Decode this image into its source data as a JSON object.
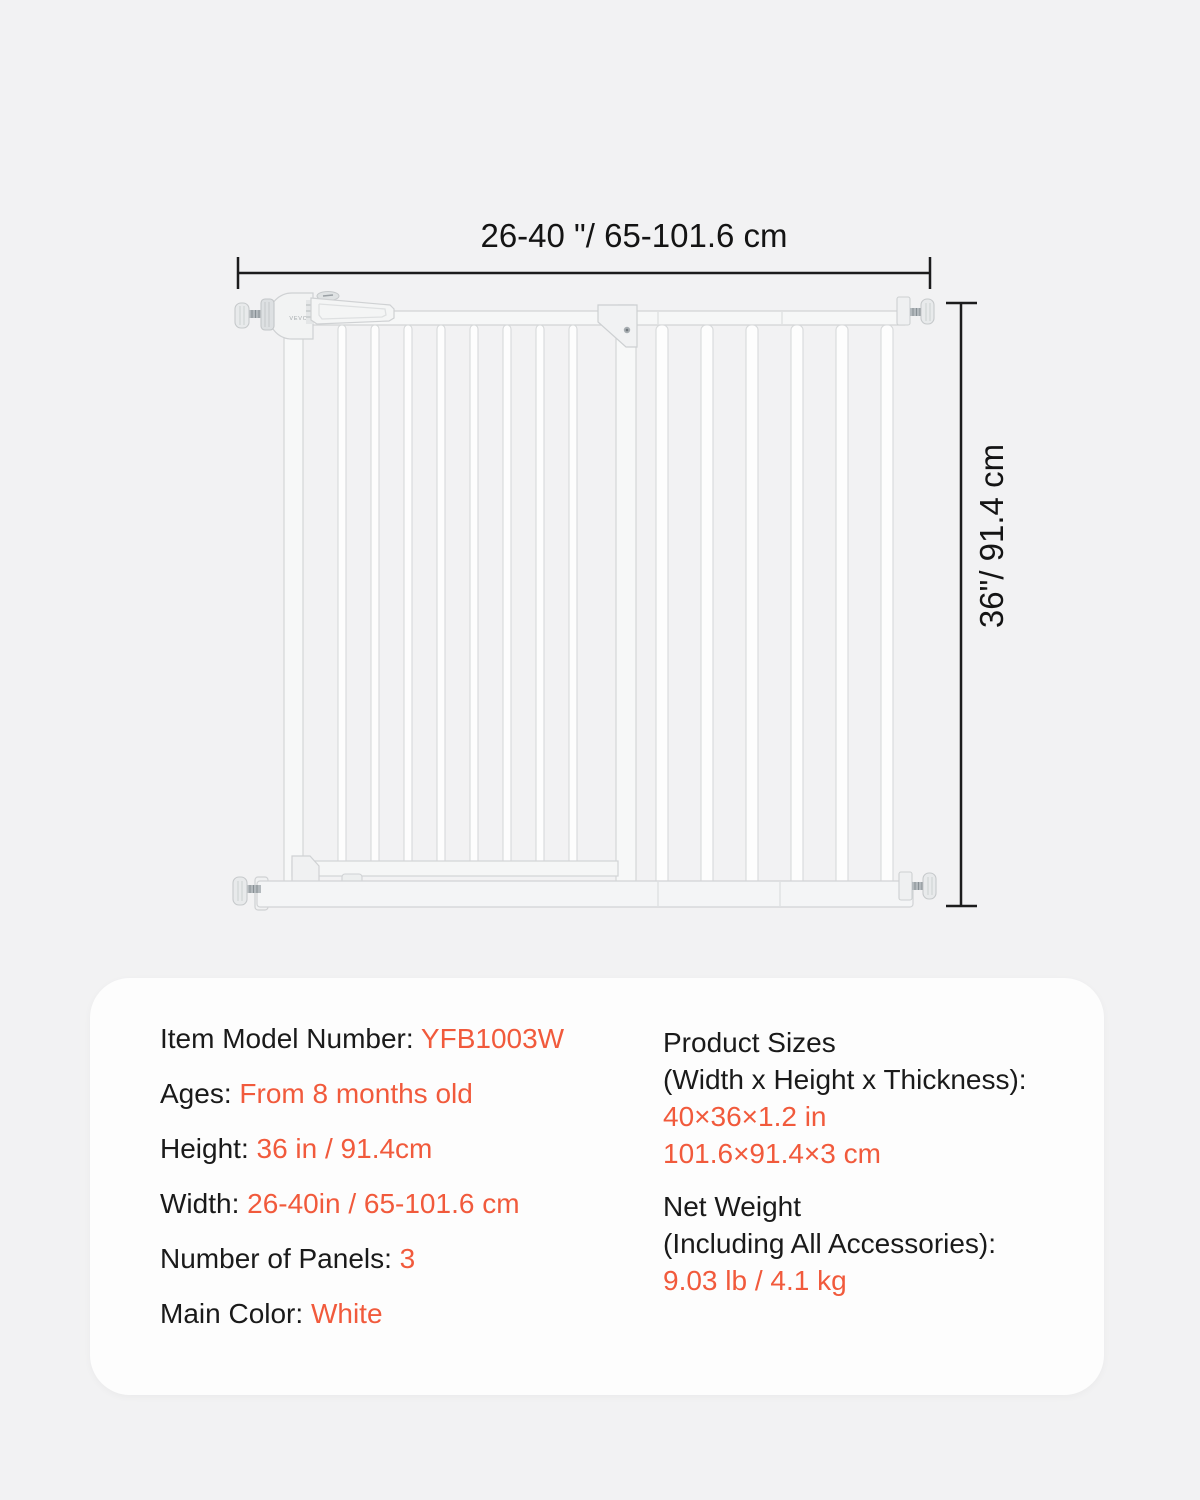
{
  "colors": {
    "accent": "#F15A3C",
    "background": "#F2F2F3",
    "card": "#FDFDFD",
    "text": "#1A1A1A",
    "dimension_line": "#1C1C1C"
  },
  "diagram": {
    "width_label": "26-40 \"/ 65-101.6 cm",
    "height_label": "36\"/ 91.4 cm",
    "brand": "VEVOR"
  },
  "specs": {
    "left": [
      {
        "label": "Item Model Number:",
        "value": "YFB1003W"
      },
      {
        "label": "Ages:",
        "value": "From 8 months old"
      },
      {
        "label": "Height:",
        "value": "36 in / 91.4cm"
      },
      {
        "label": "Width:",
        "value": "26-40in / 65-101.6 cm"
      },
      {
        "label": "Number of Panels:",
        "value": "3"
      },
      {
        "label": "Main Color:",
        "value": "White"
      }
    ],
    "right": [
      {
        "title_lines": [
          "Product Sizes",
          "(Width x Height x Thickness):"
        ],
        "value_lines": [
          "40×36×1.2 in",
          "101.6×91.4×3 cm"
        ]
      },
      {
        "title_lines": [
          "Net Weight",
          "(Including All Accessories):"
        ],
        "value_lines": [
          "9.03 lb / 4.1 kg"
        ]
      }
    ]
  }
}
